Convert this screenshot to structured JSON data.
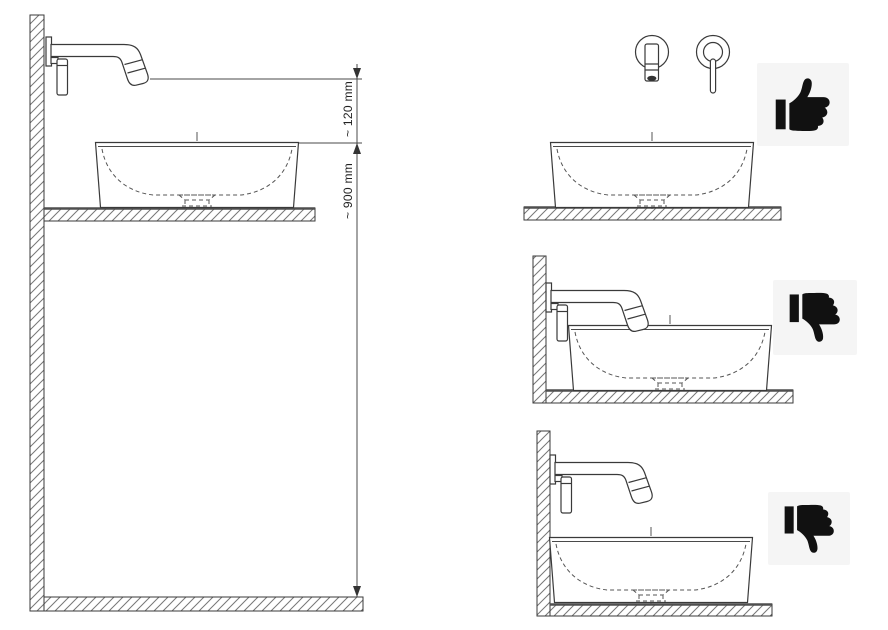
{
  "diagram": {
    "type": "installation-diagram",
    "dimension_labels": {
      "spout_to_rim": "~ 120 mm",
      "rim_to_floor": "~ 900 mm"
    },
    "panels": [
      {
        "id": "main-dimension-drawing",
        "verdict": "",
        "icon": ""
      },
      {
        "id": "front-view-example",
        "verdict": "correct",
        "icon": "thumbs-up-icon"
      },
      {
        "id": "spout-too-low-example",
        "verdict": "incorrect",
        "icon": "thumbs-down-icon"
      },
      {
        "id": "spout-too-high-example",
        "verdict": "incorrect",
        "icon": "thumbs-down-icon"
      }
    ],
    "colors": {
      "line": "#3a3a3a",
      "hatch": "#767676",
      "dashed": "#555555",
      "icon_bg": "#f5f5f5",
      "icon_fg": "#111111",
      "background": "#ffffff"
    }
  }
}
